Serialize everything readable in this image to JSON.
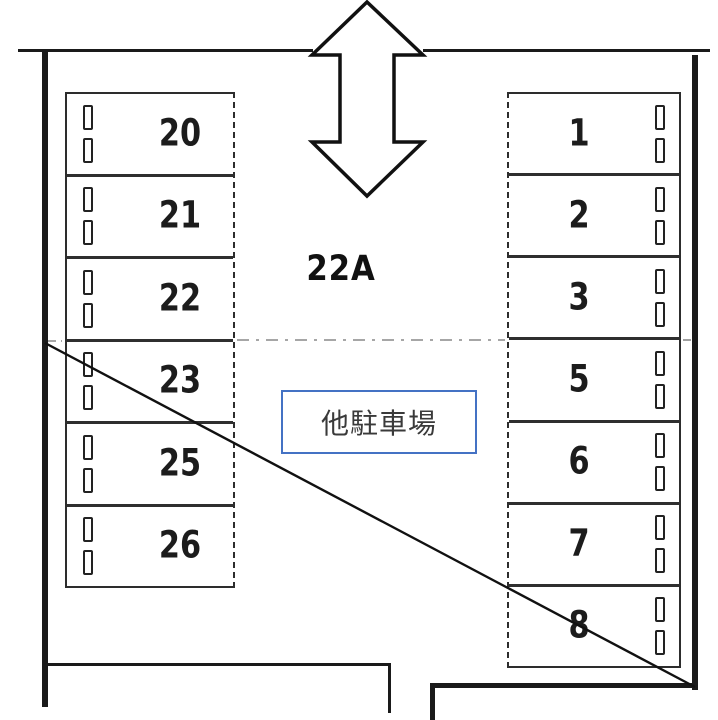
{
  "parking_map": {
    "area_label": "22A",
    "other_parking_label": "他駐車場",
    "left_spaces": [
      "20",
      "21",
      "22",
      "23",
      "25",
      "26"
    ],
    "right_spaces": [
      "1",
      "2",
      "3",
      "5",
      "6",
      "7",
      "8"
    ],
    "icons": {
      "entrance_arrow": "double-vertical-arrow-icon",
      "wheel_stop": "wheel-stop-icon"
    },
    "colors": {
      "line": "#1a1a1a",
      "accent_blue": "#4472c4",
      "background": "#ffffff"
    }
  }
}
